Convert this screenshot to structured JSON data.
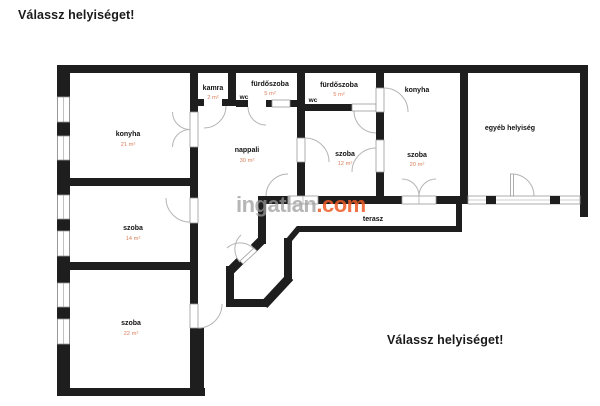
{
  "page": {
    "prompt_top": "Válassz helyiséget!",
    "prompt_bottom": "Válassz helyiséget!"
  },
  "watermark": {
    "brand": "ingatlan",
    "tld": ".com",
    "brand_color": "#9b9b9b",
    "tld_color": "#ef5a24"
  },
  "palette": {
    "wall": "#1e1e1e",
    "room_label": "#111111",
    "area_label": "#d9825f",
    "door_arc": "#b5b5b5",
    "window_line": "#9a9a9a"
  },
  "rooms": [
    {
      "name": "konyha",
      "area": "21 m²"
    },
    {
      "name": "kamra",
      "area": "2 m²"
    },
    {
      "name": "fürdőszoba",
      "area": "5 m²"
    },
    {
      "name": "wc",
      "area": ""
    },
    {
      "name": "fürdőszoba",
      "area": "5 m²"
    },
    {
      "name": "wc",
      "area": ""
    },
    {
      "name": "nappali",
      "area": "30 m²"
    },
    {
      "name": "szoba",
      "area": "12 m²"
    },
    {
      "name": "konyha",
      "area": ""
    },
    {
      "name": "szoba",
      "area": "20 m²"
    },
    {
      "name": "egyéb helyiség",
      "area": ""
    },
    {
      "name": "szoba",
      "area": "14 m²"
    },
    {
      "name": "szoba",
      "area": "22 m²"
    },
    {
      "name": "terasz",
      "area": ""
    }
  ]
}
